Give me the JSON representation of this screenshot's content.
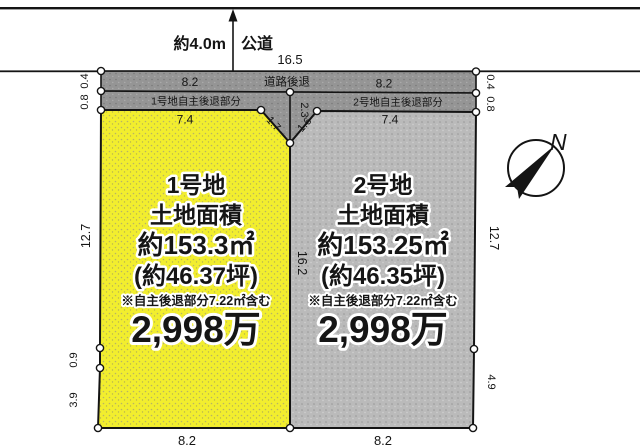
{
  "colors": {
    "plot1_fill": "#f2ee2e",
    "plot2_fill": "#bababa",
    "setback_fill": "#959595",
    "line": "#141414"
  },
  "road": {
    "width_label": "約4.0m",
    "name": "公道",
    "frontage": "16.5",
    "setback_label": "道路後退",
    "setback_width_left": "8.2",
    "setback_width_right": "8.2"
  },
  "setback_strips": {
    "plot1_label": "1号地自主後退部分",
    "plot2_label": "2号地自主後退部分"
  },
  "edge_dims": {
    "left_top_a": "0.4",
    "left_top_b": "0.8",
    "right_top_a": "0.4",
    "right_top_b": "0.8"
  },
  "plot1": {
    "name": "1号地",
    "area_heading": "土地面積",
    "area_sqm": "約153.3㎡",
    "area_tsubo": "(約46.37坪)",
    "note": "※自主後退部分7.22㎡含む",
    "price": "2,998万",
    "dim_top": "7.4",
    "dim_left": "12.7",
    "dim_left_low1": "0.9",
    "dim_left_low2": "3.9",
    "dim_bottom": "8.2",
    "dim_corner_cut": "1.7"
  },
  "plot2": {
    "name": "2号地",
    "area_heading": "土地面積",
    "area_sqm": "約153.25㎡",
    "area_tsubo": "(約46.35坪)",
    "note": "※自主後退部分7.22㎡含む",
    "price": "2,998万",
    "dim_top": "7.4",
    "dim_right": "12.7",
    "dim_right_low": "4.9",
    "dim_bottom": "8.2",
    "dim_corner_cut": "1.6",
    "dim_center_boundary": "16.2",
    "dim_notch": "2.3"
  },
  "compass": {
    "north_label": "N"
  }
}
